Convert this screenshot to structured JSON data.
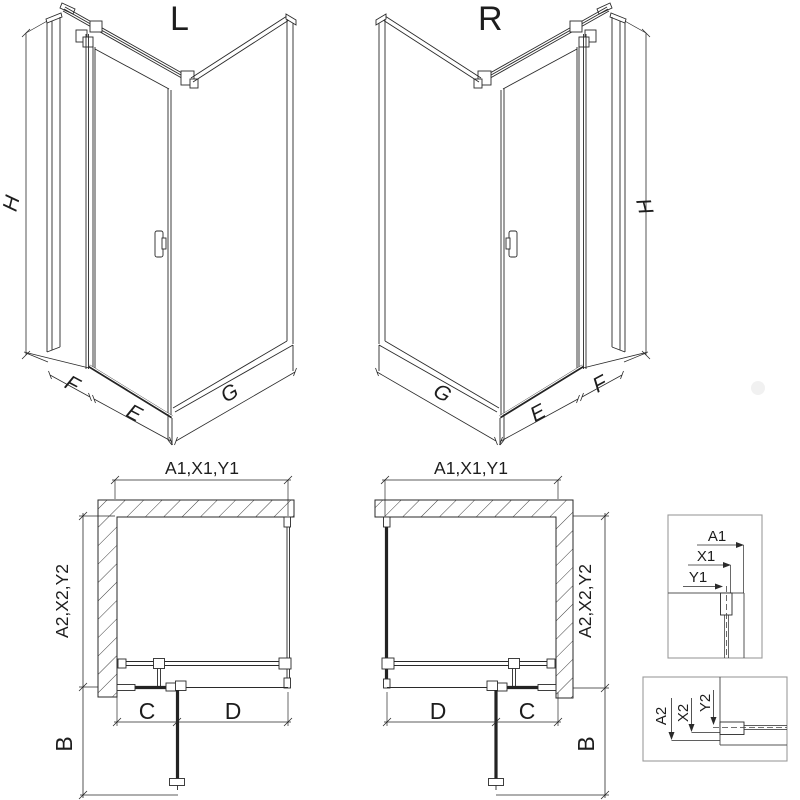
{
  "iso_left": {
    "title": "L",
    "height_dim": "H",
    "side_dim": "F",
    "door_dim": "E",
    "return_dim": "G"
  },
  "iso_right": {
    "title": "R",
    "height_dim": "H",
    "side_dim": "F",
    "door_dim": "E",
    "return_dim": "G"
  },
  "plan_left": {
    "width_dim": "A1,X1,Y1",
    "depth_dim": "A2,X2,Y2",
    "front_fixed_dim": "C",
    "front_door_dim": "D",
    "door_swing_dim": "B"
  },
  "plan_right": {
    "width_dim": "A1,X1,Y1",
    "depth_dim": "A2,X2,Y2",
    "front_fixed_dim": "C",
    "front_door_dim": "D",
    "door_swing_dim": "B"
  },
  "detail_width": {
    "labels": [
      "A1",
      "X1",
      "Y1"
    ]
  },
  "detail_depth": {
    "labels": [
      "A2",
      "X2",
      "Y2"
    ]
  },
  "colors": {
    "line": "#2a2a2a",
    "dark_rail": "#232323",
    "box_border": "#9b9b9b",
    "background": "#ffffff",
    "watermark": "#f1f1f1"
  }
}
